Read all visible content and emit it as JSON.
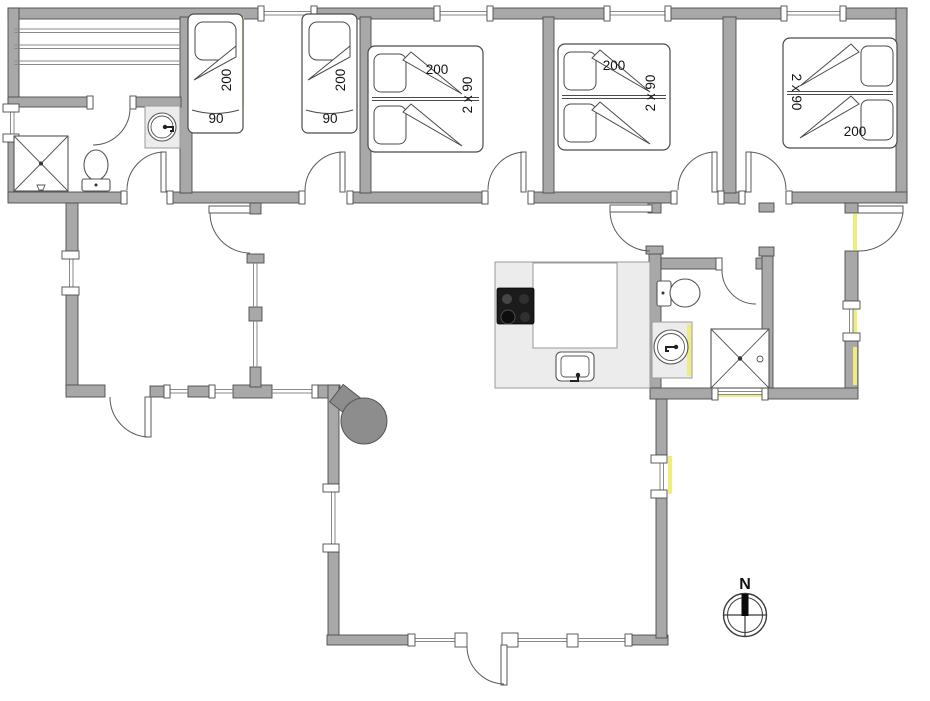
{
  "floorplan": {
    "type": "holiday-house-floor-plan",
    "compass": {
      "label": "N"
    },
    "beds": {
      "single_left": {
        "length": "200",
        "width": "90"
      },
      "single_right": {
        "length": "200",
        "width": "90"
      },
      "double_left": {
        "length": "200",
        "width": "2 x 90"
      },
      "double_mid": {
        "length": "200",
        "width": "2 x 90"
      },
      "double_right": {
        "length": "200",
        "width": "2 x 90"
      }
    },
    "icons": [
      "shower-icon",
      "toilet-icon",
      "sink-icon",
      "cooktop-icon",
      "kitchen-sink-icon",
      "wood-stove-icon",
      "compass-rose-icon"
    ],
    "colors": {
      "wall": "#a8a8a8",
      "outline": "#4c4c4c",
      "counter": "#ececec",
      "stove": "#8d8d8d",
      "accent": "#f0ec7d"
    }
  }
}
